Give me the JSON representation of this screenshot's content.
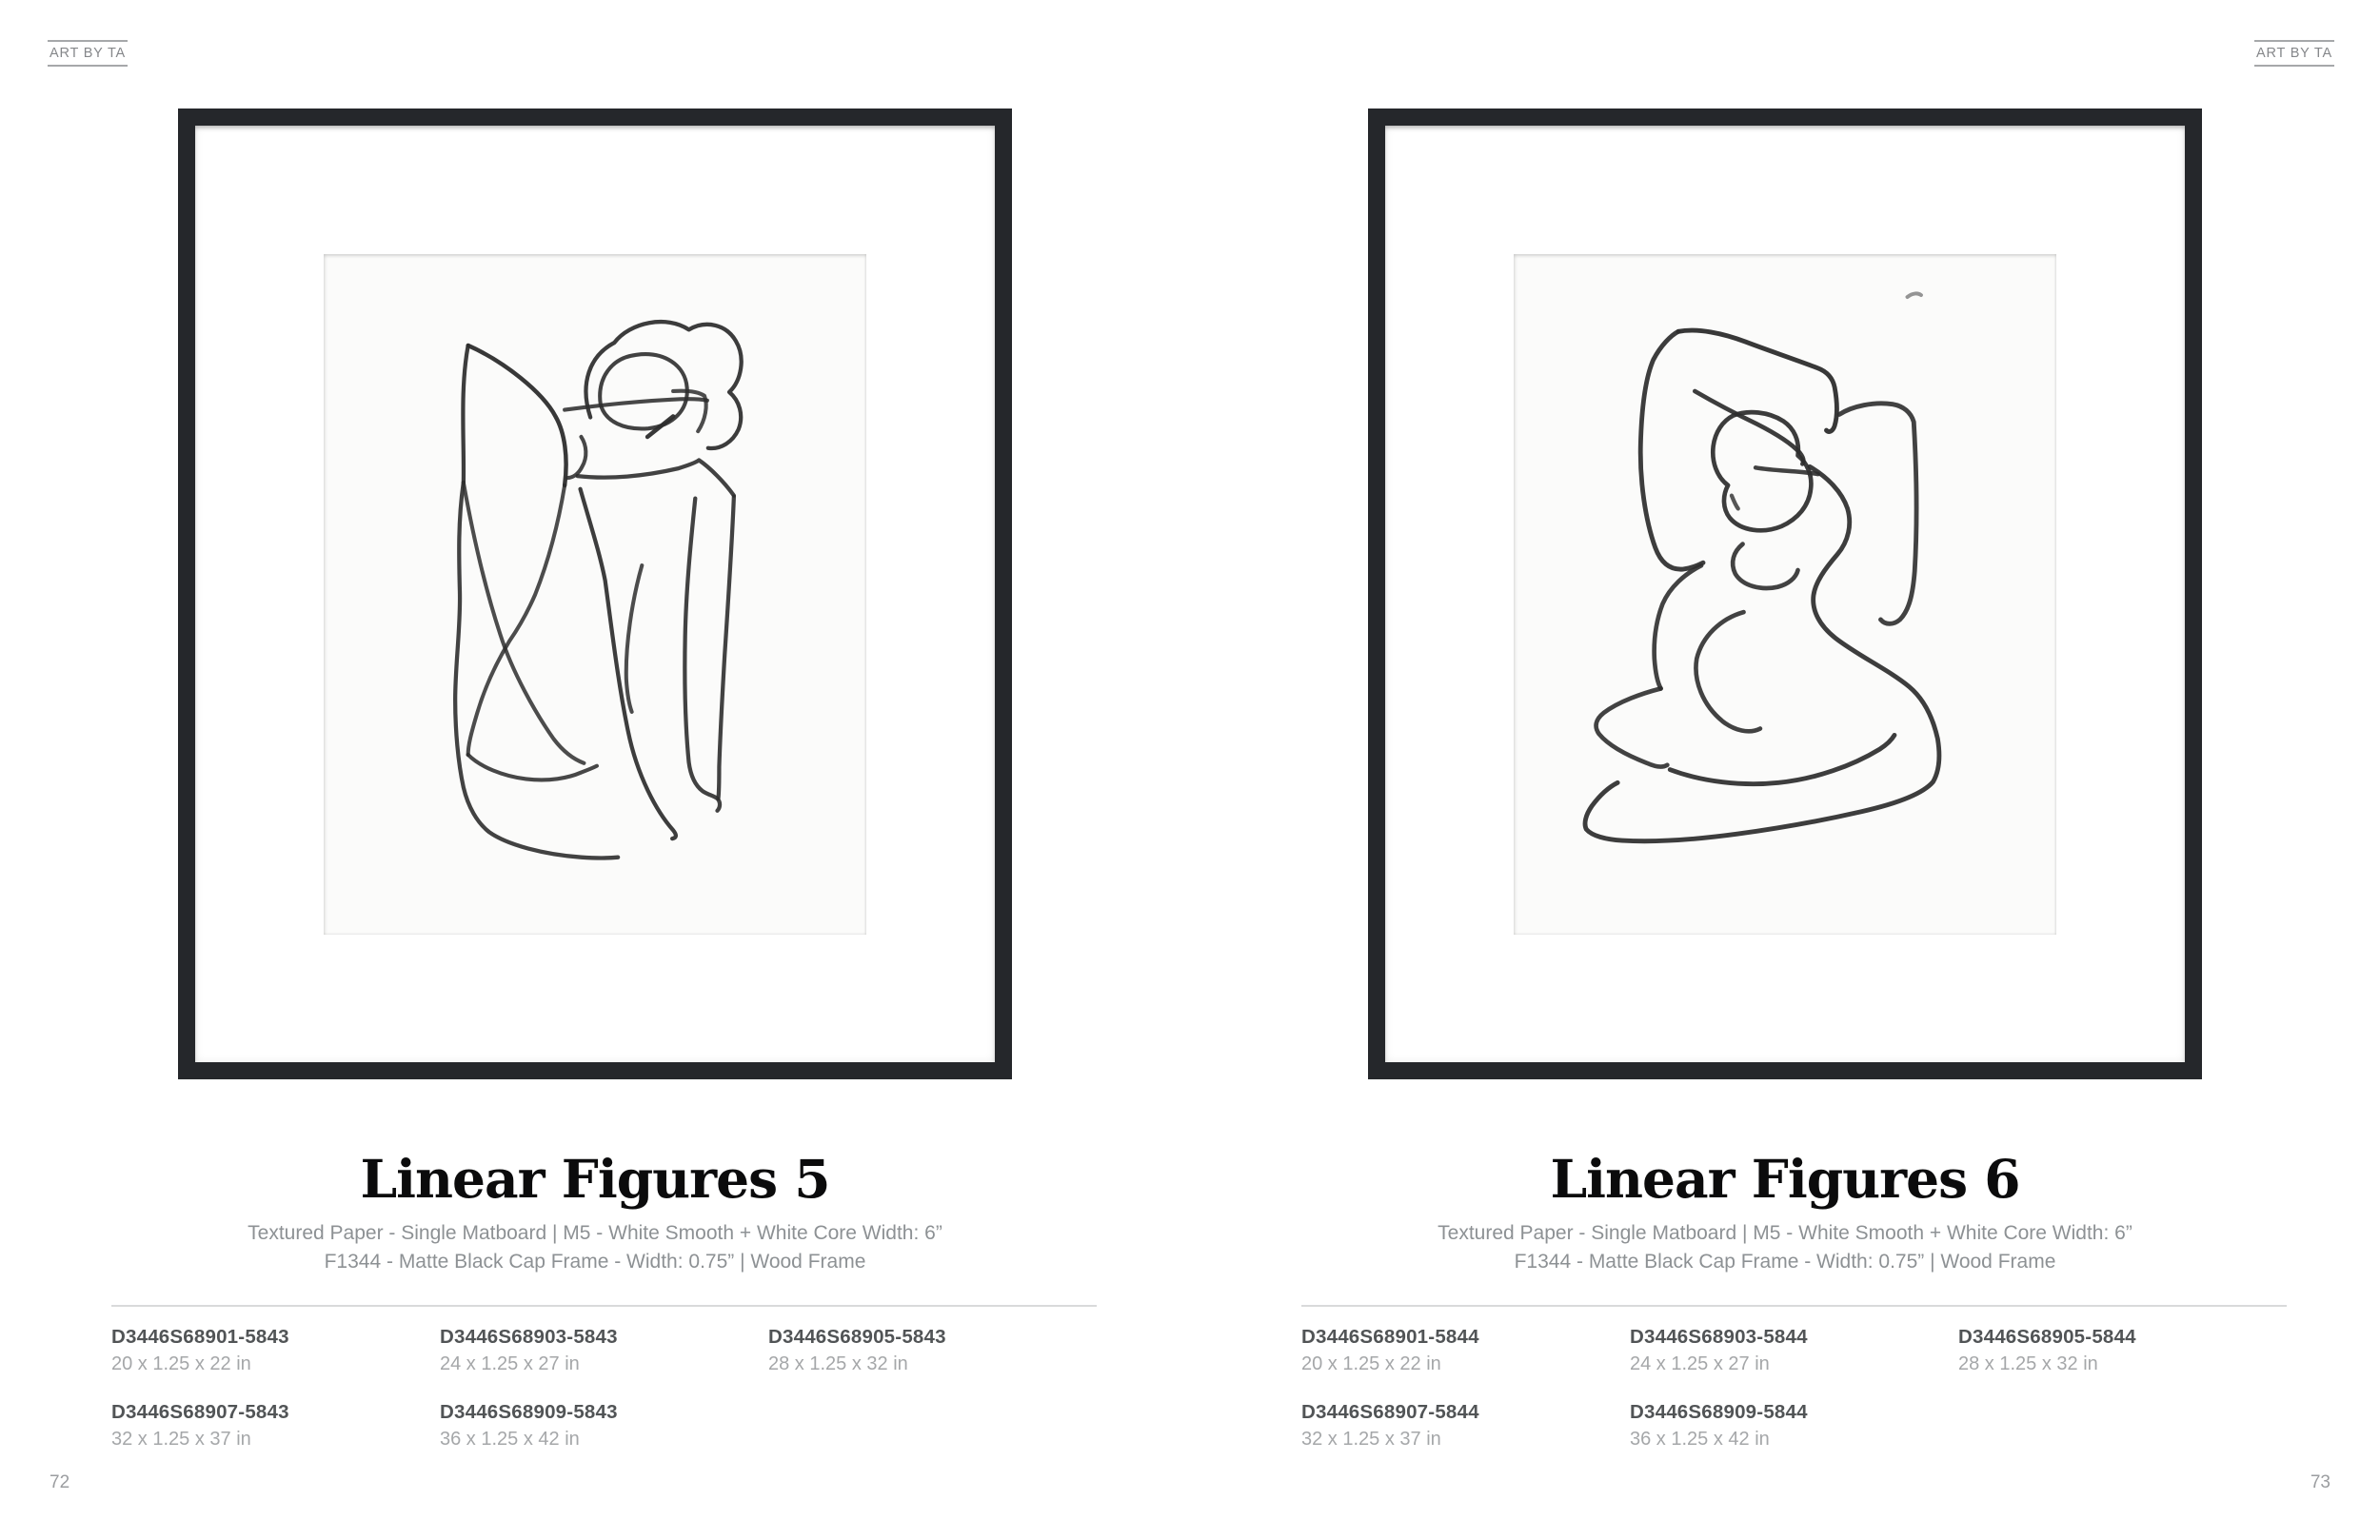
{
  "brand": "ART BY TA",
  "colors": {
    "frame": "#25272b",
    "charcoal_stroke": "#2d2d2d"
  },
  "spreads": [
    {
      "page_number": "72",
      "title": "Linear Figures 5",
      "spec_line1": "Textured Paper - Single Matboard  |  M5 - White Smooth + White Core Width: 6”",
      "spec_line2": "F1344 - Matte Black Cap Frame - Width: 0.75”  |  Wood Frame",
      "skus": [
        {
          "code": "D3446S68901-5843",
          "size": "20 x 1.25 x 22 in"
        },
        {
          "code": "D3446S68903-5843",
          "size": "24 x 1.25 x 27 in"
        },
        {
          "code": "D3446S68905-5843",
          "size": "28 x 1.25 x 32 in"
        },
        {
          "code": "D3446S68907-5843",
          "size": "32 x 1.25 x 37 in"
        },
        {
          "code": "D3446S68909-5843",
          "size": "36 x 1.25 x 42 in"
        }
      ]
    },
    {
      "page_number": "73",
      "title": "Linear Figures 6",
      "spec_line1": "Textured Paper - Single Matboard  |  M5 - White Smooth + White Core Width: 6”",
      "spec_line2": "F1344 - Matte Black Cap Frame - Width: 0.75”  |  Wood Frame",
      "skus": [
        {
          "code": "D3446S68901-5844",
          "size": "20 x 1.25 x 22 in"
        },
        {
          "code": "D3446S68903-5844",
          "size": "24 x 1.25 x 27 in"
        },
        {
          "code": "D3446S68905-5844",
          "size": "28 x 1.25 x 32 in"
        },
        {
          "code": "D3446S68907-5844",
          "size": "32 x 1.25 x 37 in"
        },
        {
          "code": "D3446S68909-5844",
          "size": "36 x 1.25 x 42 in"
        }
      ]
    }
  ]
}
